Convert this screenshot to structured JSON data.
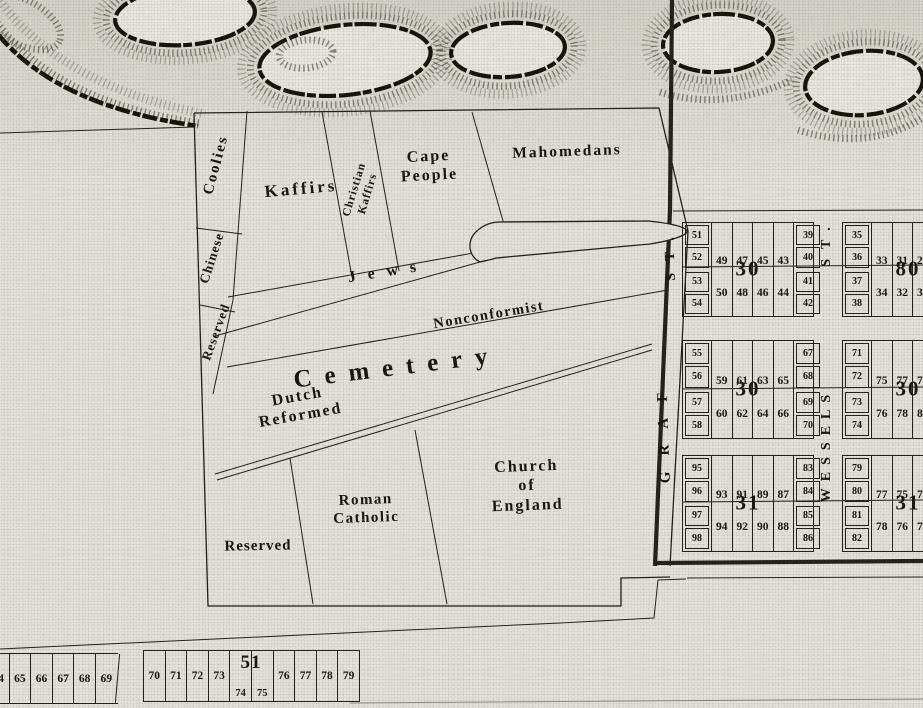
{
  "map": {
    "title_label": "Cemetery",
    "paper_color": "#e9e6de",
    "ink_color": "#26211a",
    "sections": {
      "coolies": "Coolies",
      "chinese": "Chinese",
      "reserved_upper": "Reserved",
      "kaffirs": "Kaffirs",
      "christian_kaffirs_line1": "Christian",
      "christian_kaffirs_line2": "Kaffirs",
      "cape_people_line1": "Cape",
      "cape_people_line2": "People",
      "mahomedans": "Mahomedans",
      "jews": "Jews",
      "nonconformist": "Nonconformist",
      "dutch_reformed_line1": "Dutch",
      "dutch_reformed_line2": "Reformed",
      "church_of_england_line1": "Church",
      "church_of_england_line2": "of",
      "church_of_england_line3": "England",
      "roman_catholic_line1": "Roman",
      "roman_catholic_line2": "Catholic",
      "reserved_lower": "Reserved"
    },
    "streets": {
      "graf_name": "GRAF",
      "graf_suffix": "ST.",
      "wessels_name": "WESSELS",
      "wessels_suffix": "ST."
    },
    "grid_blocks": [
      {
        "label": "30",
        "top": {
          "left": [
            "51",
            "52"
          ],
          "wide": [
            "49",
            "47",
            "45",
            "43"
          ],
          "right": [
            "39",
            "40"
          ]
        },
        "bottom": {
          "left": [
            "53",
            "54"
          ],
          "wide": [
            "50",
            "48",
            "46",
            "44"
          ],
          "right": [
            "41",
            "42"
          ]
        }
      },
      {
        "label": "80",
        "top": {
          "left": [
            "35",
            "36"
          ],
          "wide": [
            "33",
            "31",
            "29"
          ]
        },
        "bottom": {
          "left": [
            "37",
            "38"
          ],
          "wide": [
            "34",
            "32",
            "30"
          ]
        }
      },
      {
        "label": "30",
        "top": {
          "left": [
            "55",
            "56"
          ],
          "wide": [
            "59",
            "61",
            "63",
            "65"
          ],
          "right": [
            "67",
            "68"
          ]
        },
        "bottom": {
          "left": [
            "57",
            "58"
          ],
          "wide": [
            "60",
            "62",
            "64",
            "66"
          ],
          "right": [
            "69",
            "70"
          ]
        }
      },
      {
        "label": "30",
        "top": {
          "left": [
            "71",
            "72"
          ],
          "wide": [
            "75",
            "77",
            "79"
          ]
        },
        "bottom": {
          "left": [
            "73",
            "74"
          ],
          "wide": [
            "76",
            "78",
            "80"
          ]
        }
      },
      {
        "label": "31",
        "top": {
          "left": [
            "95",
            "96"
          ],
          "wide": [
            "93",
            "91",
            "89",
            "87"
          ],
          "right": [
            "83",
            "84"
          ]
        },
        "bottom": {
          "left": [
            "97",
            "98"
          ],
          "wide": [
            "94",
            "92",
            "90",
            "88"
          ],
          "right": [
            "85",
            "86"
          ]
        }
      },
      {
        "label": "31",
        "top": {
          "left": [
            "79",
            "80"
          ],
          "wide": [
            "77",
            "75",
            "73"
          ]
        },
        "bottom": {
          "left": [
            "81",
            "82"
          ],
          "wide": [
            "78",
            "76",
            "74"
          ]
        }
      }
    ],
    "bottom_plots": {
      "left_cells": [
        "64",
        "65",
        "66",
        "67",
        "68",
        "69"
      ],
      "right_cells": [
        "70",
        "71",
        "72",
        "73",
        "74",
        "75",
        "76",
        "77",
        "78",
        "79"
      ],
      "right_label": "51"
    }
  }
}
